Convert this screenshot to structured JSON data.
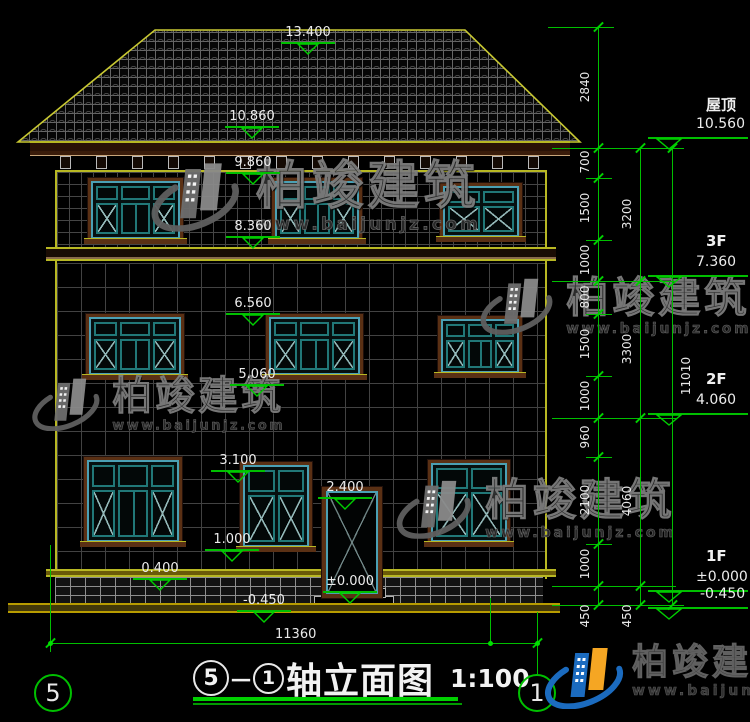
{
  "title": {
    "axis_from": "5",
    "dash": "－",
    "axis_to": "1",
    "name": "轴立面图",
    "scale": "1:100"
  },
  "brand": {
    "name": "柏竣建筑",
    "url": "www.baijunjz.com"
  },
  "colors": {
    "cad_green": "#00bf00",
    "outline_yellow": "#b8b823",
    "dim_white": "#e8e8e8",
    "frame_brown": "#5a3014",
    "frame_blue": "#4ba0b4",
    "frame_teal": "#217878",
    "brand_blue": "#1b6bbf",
    "brand_orange": "#f5a623"
  },
  "axis_bubbles": [
    {
      "label": "5",
      "x": 51,
      "y": 691
    },
    {
      "label": "1",
      "x": 535,
      "y": 691
    }
  ],
  "floor_markers": [
    {
      "label": "屋顶",
      "value": "10.560",
      "line_y": 137
    },
    {
      "label": "3F",
      "value": "7.360",
      "line_y": 275
    },
    {
      "label": "2F",
      "value": "4.060",
      "line_y": 413
    },
    {
      "label": "1F",
      "value": "±0.000",
      "line_y": 590
    },
    {
      "label": "",
      "value": "-0.450",
      "line_y": 607
    }
  ],
  "elevation_markers": [
    {
      "value": "13.400",
      "x": 308,
      "line_y": 42
    },
    {
      "value": "10.860",
      "x": 252,
      "line_y": 126
    },
    {
      "value": "9.860",
      "x": 253,
      "line_y": 172
    },
    {
      "value": "8.360",
      "x": 253,
      "line_y": 236
    },
    {
      "value": "6.560",
      "x": 253,
      "line_y": 313
    },
    {
      "value": "5.060",
      "x": 257,
      "line_y": 384
    },
    {
      "value": "3.100",
      "x": 238,
      "line_y": 470
    },
    {
      "value": "2.400",
      "x": 345,
      "line_y": 497
    },
    {
      "value": "1.000",
      "x": 232,
      "line_y": 549
    },
    {
      "value": "0.400",
      "x": 160,
      "line_y": 578
    },
    {
      "value": "±0.000",
      "x": 350,
      "line_y": 591
    },
    {
      "value": "-0.450",
      "x": 264,
      "line_y": 610
    }
  ],
  "dim_chains": [
    {
      "x": 598,
      "text_dx": -13,
      "boundaries": [
        27,
        148,
        178,
        240,
        281,
        314,
        376,
        418,
        457,
        544,
        586,
        605
      ],
      "labels": [
        "2840",
        "700",
        "1500",
        "1000",
        "800",
        "1500",
        "1000",
        "960",
        "2100",
        "1000",
        "450"
      ]
    },
    {
      "x": 640,
      "text_dx": -13,
      "boundaries": [
        148,
        281,
        418,
        586,
        605
      ],
      "labels": [
        "3200",
        "3300",
        "4060",
        "450"
      ]
    },
    {
      "x": 672,
      "text_dx": 14,
      "boundaries": [
        148,
        605
      ],
      "labels": [
        "11010"
      ]
    }
  ],
  "connector_levels": [
    {
      "y": 27,
      "x1": 548,
      "x2": 614
    },
    {
      "y": 148,
      "x1": 552,
      "x2": 676
    },
    {
      "y": 281,
      "x1": 552,
      "x2": 676
    },
    {
      "y": 418,
      "x1": 552,
      "x2": 676
    },
    {
      "y": 586,
      "x1": 552,
      "x2": 676
    },
    {
      "y": 605,
      "x1": 552,
      "x2": 676
    }
  ],
  "window_level_ticks": [
    178,
    240,
    314,
    376,
    457,
    544
  ],
  "bottom_dim": {
    "label": "11360",
    "y": 643,
    "x1": 50,
    "x2": 537,
    "text_x": 300
  },
  "extension_lines": [
    {
      "x": 50,
      "y1": 545,
      "y2": 652
    },
    {
      "x": 490,
      "y1": 598,
      "y2": 643
    },
    {
      "x": 537,
      "y1": 612,
      "y2": 674
    }
  ],
  "dim_dots": [
    {
      "x": 50,
      "y": 643
    },
    {
      "x": 490,
      "y": 643
    },
    {
      "x": 537,
      "y": 643
    }
  ],
  "windows": [
    {
      "x": 88,
      "y": 178,
      "w": 95,
      "h": 64,
      "cols": 3
    },
    {
      "x": 272,
      "y": 178,
      "w": 90,
      "h": 64,
      "cols": 3
    },
    {
      "x": 440,
      "y": 183,
      "w": 82,
      "h": 57,
      "cols": 2
    },
    {
      "x": 86,
      "y": 314,
      "w": 98,
      "h": 64,
      "cols": 3
    },
    {
      "x": 266,
      "y": 314,
      "w": 97,
      "h": 64,
      "cols": 3
    },
    {
      "x": 438,
      "y": 316,
      "w": 84,
      "h": 60,
      "cols": 3
    },
    {
      "x": 84,
      "y": 457,
      "w": 98,
      "h": 88,
      "cols": 3
    },
    {
      "x": 240,
      "y": 462,
      "w": 72,
      "h": 88,
      "cols": 2
    },
    {
      "x": 428,
      "y": 460,
      "w": 82,
      "h": 85,
      "cols": 2
    }
  ],
  "brackets": {
    "count": 14,
    "x_start": 60,
    "x_end": 528,
    "y": 156
  },
  "watermarks": [
    {
      "x": 146,
      "y": 160,
      "s": 1.12
    },
    {
      "x": 476,
      "y": 276,
      "s": 0.92
    },
    {
      "x": 28,
      "y": 376,
      "s": 0.86
    },
    {
      "x": 392,
      "y": 478,
      "s": 0.95
    }
  ]
}
